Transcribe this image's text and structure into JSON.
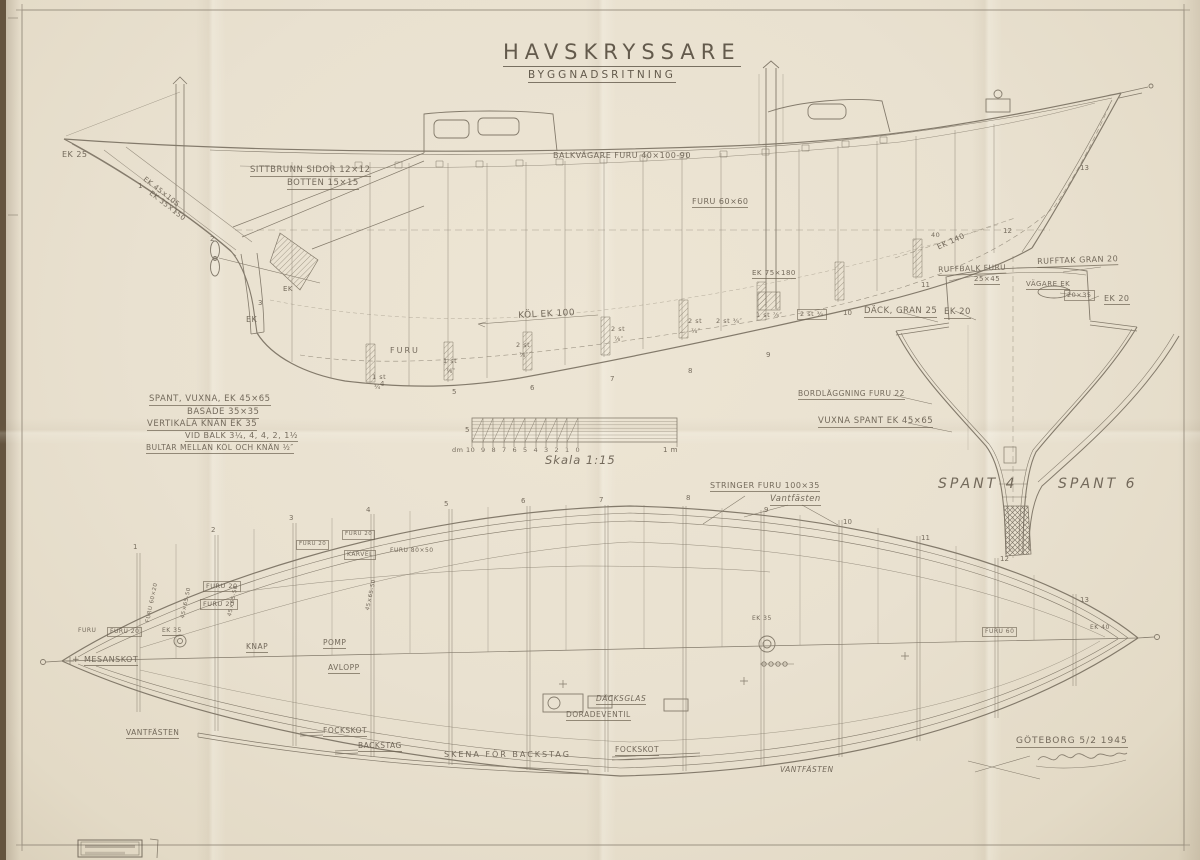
{
  "title": {
    "main": "HAVSKRYSSARE",
    "sub": "BYGGNADSRITNING"
  },
  "colors": {
    "paper": "#e9e1d0",
    "line": "#7b7263",
    "text": "#6b6153",
    "backing": "#64543f"
  },
  "scale": {
    "caption": "Skala 1:15",
    "left_mark": "5",
    "dm_label": "dm 10",
    "meter_label": "1 m",
    "ticks": [
      "9",
      "8",
      "7",
      "6",
      "5",
      "4",
      "3",
      "2",
      "1",
      "0"
    ]
  },
  "stations_side": [
    [
      1,
      138,
      183
    ],
    [
      2,
      210,
      236
    ],
    [
      3,
      258,
      300
    ],
    [
      4,
      380,
      381
    ],
    [
      5,
      452,
      389
    ],
    [
      6,
      530,
      385
    ],
    [
      7,
      610,
      376
    ],
    [
      8,
      688,
      368
    ],
    [
      9,
      766,
      352
    ],
    [
      10,
      843,
      310
    ],
    [
      11,
      921,
      282
    ],
    [
      12,
      1003,
      228
    ],
    [
      13,
      1080,
      165
    ]
  ],
  "stations_plan": [
    [
      1,
      133,
      544
    ],
    [
      2,
      211,
      527
    ],
    [
      3,
      289,
      515
    ],
    [
      4,
      366,
      507
    ],
    [
      5,
      444,
      501
    ],
    [
      6,
      521,
      498
    ],
    [
      7,
      599,
      497
    ],
    [
      8,
      686,
      495
    ],
    [
      9,
      764,
      507
    ],
    [
      10,
      843,
      519
    ],
    [
      11,
      921,
      535
    ],
    [
      12,
      1000,
      556
    ],
    [
      13,
      1080,
      597
    ]
  ],
  "labels": [
    {
      "n": "ek-25",
      "t": "EK 25",
      "x": 62,
      "y": 151,
      "s": 8
    },
    {
      "n": "stem-scantling-1",
      "t": "EK 45×105",
      "x": 146,
      "y": 176,
      "s": 7,
      "r": 38
    },
    {
      "n": "stem-scantling-2",
      "t": "EK 35×150",
      "x": 152,
      "y": 190,
      "s": 7,
      "r": 38
    },
    {
      "n": "sittbrunn-sides",
      "t": "SITTBRUNN SIDOR 12×12",
      "x": 250,
      "y": 166,
      "s": 8.5,
      "u": 1
    },
    {
      "n": "sittbrunn-bottom",
      "t": "BOTTEN 15×15",
      "x": 287,
      "y": 179,
      "s": 8.5,
      "u": 1
    },
    {
      "n": "balkvagare",
      "t": "BALKVÄGARE  FURU  40×100-90",
      "x": 553,
      "y": 152,
      "s": 8
    },
    {
      "n": "furu-60-60",
      "t": "FURU 60×60",
      "x": 692,
      "y": 198,
      "s": 8,
      "u": 1
    },
    {
      "n": "ek-140",
      "t": "EK 140",
      "x": 936,
      "y": 244,
      "s": 7.5,
      "r": -24
    },
    {
      "n": "ek-75-180",
      "t": "EK  75×180",
      "x": 752,
      "y": 270,
      "s": 7,
      "u": 1
    },
    {
      "n": "ruffbalk-1",
      "t": "RUFFBALK FURU",
      "x": 938,
      "y": 266,
      "s": 7.5,
      "u": 1,
      "r": -2
    },
    {
      "n": "ruffbalk-2",
      "t": "25×45",
      "x": 974,
      "y": 276,
      "s": 7,
      "u": 1
    },
    {
      "n": "rufftak",
      "t": "RUFFTAK GRAN 20",
      "x": 1037,
      "y": 258,
      "s": 8,
      "u": 1,
      "r": -2
    },
    {
      "n": "vagare-ek",
      "t": "VÄGARE EK",
      "x": 1026,
      "y": 281,
      "s": 7,
      "u": 1
    },
    {
      "n": "vagare-dim",
      "t": "20×35",
      "x": 1064,
      "y": 290,
      "s": 6.5,
      "bx": 1
    },
    {
      "n": "ek-20-trunk",
      "t": "EK 20",
      "x": 1104,
      "y": 295,
      "s": 8,
      "u": 1
    },
    {
      "n": "dack-gran-25",
      "t": "DÄCK, GRAN 25",
      "x": 864,
      "y": 307,
      "s": 8.5,
      "u": 1
    },
    {
      "n": "ek-20-deck",
      "t": "EK 20",
      "x": 944,
      "y": 308,
      "s": 8.5,
      "u": 1
    },
    {
      "n": "kol-ek-100",
      "t": "KÖL  EK  100",
      "x": 518,
      "y": 312,
      "s": 9,
      "r": -3
    },
    {
      "n": "furu-keel",
      "t": "FURU",
      "x": 390,
      "y": 347,
      "s": 8,
      "ls": 2
    },
    {
      "n": "ek-deadwood-1",
      "t": "EK",
      "x": 283,
      "y": 286,
      "s": 7
    },
    {
      "n": "ek-deadwood-2",
      "t": "EK",
      "x": 246,
      "y": 316,
      "s": 8
    },
    {
      "n": "bolt-1a",
      "t": "1 st",
      "x": 372,
      "y": 374,
      "s": 6.5
    },
    {
      "n": "bolt-1b",
      "t": "¾″",
      "x": 374,
      "y": 384,
      "s": 6.5
    },
    {
      "n": "bolt-2a",
      "t": "1 st",
      "x": 443,
      "y": 358,
      "s": 6.5
    },
    {
      "n": "bolt-2b",
      "t": "⅞″",
      "x": 446,
      "y": 368,
      "s": 6.5
    },
    {
      "n": "bolt-3a",
      "t": "2 st",
      "x": 516,
      "y": 342,
      "s": 6.5
    },
    {
      "n": "bolt-3b",
      "t": "⅞″",
      "x": 519,
      "y": 352,
      "s": 6.5
    },
    {
      "n": "bolt-4a",
      "t": "2 st",
      "x": 611,
      "y": 326,
      "s": 6.5
    },
    {
      "n": "bolt-4b",
      "t": "⅞″",
      "x": 614,
      "y": 336,
      "s": 6.5
    },
    {
      "n": "bolt-5a",
      "t": "2 st",
      "x": 688,
      "y": 318,
      "s": 6.5
    },
    {
      "n": "bolt-5b",
      "t": "⅞″",
      "x": 691,
      "y": 328,
      "s": 6.5
    },
    {
      "n": "bolt-6",
      "t": "2 st ¾″",
      "x": 716,
      "y": 318,
      "s": 6.5
    },
    {
      "n": "bolt-7",
      "t": "1 st ⅞″",
      "x": 756,
      "y": 312,
      "s": 6.5
    },
    {
      "n": "bolt-8",
      "t": "2 st ¾",
      "x": 797,
      "y": 309,
      "s": 6.5,
      "bx": 1
    },
    {
      "n": "mark-40",
      "t": "40",
      "x": 931,
      "y": 232,
      "s": 6.5
    },
    {
      "n": "spec-spant",
      "t": "SPANT, VUXNA, EK 45×65",
      "x": 149,
      "y": 395,
      "s": 8.5,
      "u": 1
    },
    {
      "n": "spec-basade",
      "t": "BASADE  35×35",
      "x": 187,
      "y": 408,
      "s": 8.5,
      "u": 1
    },
    {
      "n": "spec-knan",
      "t": "VERTIKALA KNÄN  EK 35",
      "x": 147,
      "y": 420,
      "s": 8.5,
      "u": 1
    },
    {
      "n": "spec-vid-balk",
      "t": "VID BALK 3¼, 4, 4, 2, 1½",
      "x": 185,
      "y": 432,
      "s": 8,
      "u": 1
    },
    {
      "n": "spec-bultar",
      "t": "BULTAR MELLAN KÖL OCH KNÄN ½″",
      "x": 146,
      "y": 444,
      "s": 7.5,
      "u": 1
    },
    {
      "n": "scale-5",
      "t": "5",
      "x": 465,
      "y": 427,
      "s": 7
    },
    {
      "n": "scale-dm",
      "t": "dm 10",
      "x": 452,
      "y": 447,
      "s": 6.5
    },
    {
      "n": "scale-1m",
      "t": "1 m",
      "x": 663,
      "y": 447,
      "s": 7
    },
    {
      "n": "scale-caption",
      "t": "Skala 1:15",
      "x": 545,
      "y": 455,
      "s": 11.5,
      "i": 1,
      "ls": 1
    },
    {
      "n": "bordlaggning",
      "t": "BORDLÄGGNING FURU 22",
      "x": 798,
      "y": 390,
      "s": 7.5,
      "u": 1
    },
    {
      "n": "vuxna-spant",
      "t": "VUXNA SPANT EK 45×65",
      "x": 818,
      "y": 417,
      "s": 8.5,
      "u": 1
    },
    {
      "n": "spant-4",
      "t": "SPANT 4",
      "x": 938,
      "y": 477,
      "s": 14,
      "ls": 3,
      "i": 1
    },
    {
      "n": "spant-6",
      "t": "SPANT 6",
      "x": 1058,
      "y": 477,
      "s": 14,
      "ls": 3,
      "i": 1
    },
    {
      "n": "stringer",
      "t": "STRINGER  FURU 100×35",
      "x": 710,
      "y": 482,
      "s": 8,
      "u": 1
    },
    {
      "n": "vantfasten-top",
      "t": "Vantfästen",
      "x": 770,
      "y": 495,
      "s": 8.5,
      "i": 1,
      "u": 1
    },
    {
      "n": "furu-small",
      "t": "FURU",
      "x": 78,
      "y": 628,
      "s": 6
    },
    {
      "n": "furu20-a",
      "t": "FURU 20",
      "x": 107,
      "y": 627,
      "s": 6,
      "bx": 1
    },
    {
      "n": "ek-35-plan",
      "t": "EK 35",
      "x": 162,
      "y": 628,
      "s": 6,
      "u": 1
    },
    {
      "n": "plus-mesan",
      "t": "+",
      "x": 72,
      "y": 656,
      "s": 9
    },
    {
      "n": "mesanskot",
      "t": "MESANSKOT",
      "x": 84,
      "y": 656,
      "s": 8,
      "u": 1
    },
    {
      "n": "furu20-box1",
      "t": "FURU 20",
      "x": 203,
      "y": 581,
      "s": 6.5,
      "bx": 1
    },
    {
      "n": "furu20-box2",
      "t": "FURU 20",
      "x": 200,
      "y": 599,
      "s": 6.5,
      "bx": 1
    },
    {
      "n": "vert-dim-a",
      "t": "45×65-50",
      "x": 181,
      "y": 618,
      "s": 5.5,
      "r": -78
    },
    {
      "n": "vert-dim-b",
      "t": "45×65-50",
      "x": 228,
      "y": 616,
      "s": 5.5,
      "r": -78
    },
    {
      "n": "vert-dim-c",
      "t": "45×65-50",
      "x": 366,
      "y": 610,
      "s": 5.5,
      "r": -78
    },
    {
      "n": "vert-furu-60-20",
      "t": "FURU 60×20",
      "x": 146,
      "y": 622,
      "s": 5.5,
      "r": -78
    },
    {
      "n": "furu20-box3",
      "t": "FURU 20",
      "x": 296,
      "y": 540,
      "s": 5.5,
      "bx": 1
    },
    {
      "n": "furu20-box4",
      "t": "FURU 20",
      "x": 342,
      "y": 530,
      "s": 5.5,
      "bx": 1
    },
    {
      "n": "karvel",
      "t": "KARVEL",
      "x": 344,
      "y": 550,
      "s": 6,
      "bx": 1
    },
    {
      "n": "furu-80-50",
      "t": "FURU 80×50",
      "x": 390,
      "y": 548,
      "s": 6
    },
    {
      "n": "knap",
      "t": "KNAP",
      "x": 246,
      "y": 643,
      "s": 7.5,
      "u": 1
    },
    {
      "n": "pump",
      "t": "POMP",
      "x": 323,
      "y": 639,
      "s": 7.5,
      "u": 1
    },
    {
      "n": "avlopp",
      "t": "AVLOPP",
      "x": 328,
      "y": 664,
      "s": 7.5,
      "u": 1
    },
    {
      "n": "dacksglas",
      "t": "DÄCKSGLAS",
      "x": 596,
      "y": 695,
      "s": 7.5,
      "u": 1,
      "i": 1
    },
    {
      "n": "doradeventil",
      "t": "DORADEVENTIL",
      "x": 566,
      "y": 711,
      "s": 7.5,
      "u": 1
    },
    {
      "n": "vantfasten-left",
      "t": "VANTFÄSTEN",
      "x": 126,
      "y": 729,
      "s": 7.5,
      "u": 1
    },
    {
      "n": "fockskot-left",
      "t": "FOCKSKOT",
      "x": 323,
      "y": 727,
      "s": 7.5,
      "u": 1
    },
    {
      "n": "backstag",
      "t": "BACKSTAG",
      "x": 358,
      "y": 742,
      "s": 7.5,
      "u": 1
    },
    {
      "n": "skena-for-backstag",
      "t": "SKENA  FÖR  BACKSTAG",
      "x": 444,
      "y": 751,
      "s": 8,
      "ls": 2
    },
    {
      "n": "fockskot-mid",
      "t": "FOCKSKOT",
      "x": 615,
      "y": 746,
      "s": 7.5,
      "u": 1
    },
    {
      "n": "vantfasten-right",
      "t": "VANTFÄSTEN",
      "x": 780,
      "y": 766,
      "s": 7.5,
      "i": 1
    },
    {
      "n": "furu-60-plan",
      "t": "FURU 60",
      "x": 982,
      "y": 627,
      "s": 6,
      "bx": 1
    },
    {
      "n": "ek-40-plan",
      "t": "EK 40",
      "x": 1090,
      "y": 625,
      "s": 6
    },
    {
      "n": "ek-35-mast",
      "t": "EK 35",
      "x": 752,
      "y": 616,
      "s": 6
    },
    {
      "n": "place-date",
      "t": "GÖTEBORG 5/2 1945",
      "x": 1016,
      "y": 737,
      "s": 9,
      "u": 1,
      "ls": 1
    }
  ]
}
